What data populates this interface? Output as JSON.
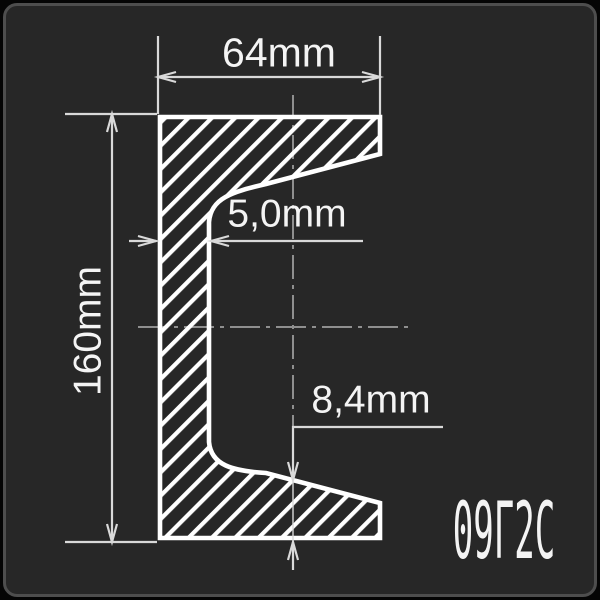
{
  "drawing": {
    "type": "channel-steel-cross-section",
    "steel_grade_label": "09Г2С",
    "dimensions": {
      "width": {
        "label": "64mm",
        "value": 64,
        "unit": "mm",
        "meaning": "flange width"
      },
      "height": {
        "label": "160mm",
        "value": 160,
        "unit": "mm",
        "meaning": "profile height"
      },
      "web": {
        "label": "5,0mm",
        "value": 5.0,
        "unit": "mm",
        "meaning": "web thickness"
      },
      "flange": {
        "label": "8,4mm",
        "value": 8.4,
        "unit": "mm",
        "meaning": "flange thickness"
      }
    },
    "colors": {
      "background": "#050505",
      "card": "#272727",
      "card_border": "#4e4e4e",
      "profile_line": "#ffffff",
      "dimension_line": "#d9d9d9",
      "centerline": "#8f8f8f",
      "text": "#f4f4f4"
    }
  }
}
